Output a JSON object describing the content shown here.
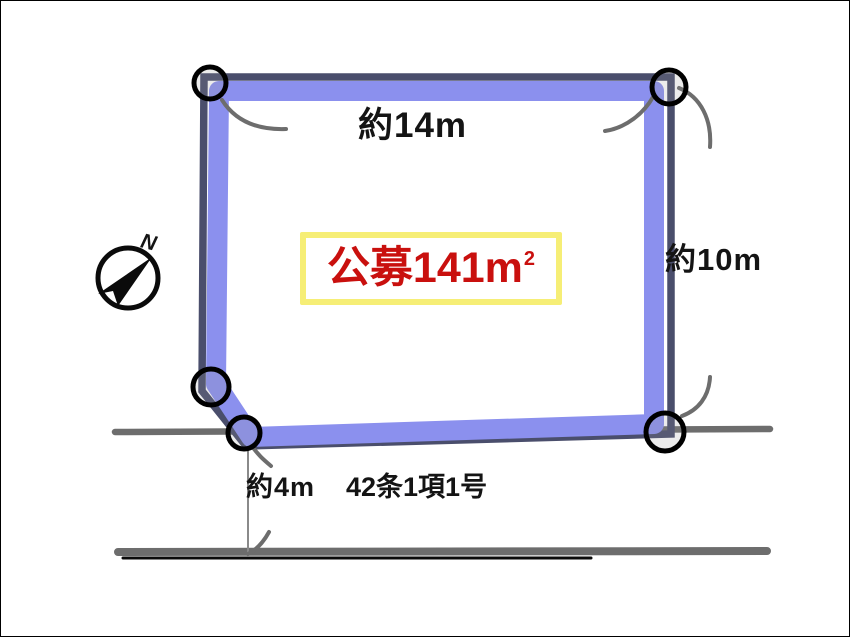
{
  "page": {
    "background": "#ffffff",
    "frame_color": "#000000"
  },
  "compass": {
    "north_label": "N",
    "direction": "northeast",
    "color": "#0b0b0b"
  },
  "plot": {
    "area_label": {
      "value": "公募141m",
      "sup": "2"
    },
    "area_text_color": "#c9100e",
    "area_box_border_color": "#f6ee76",
    "border_band_color": "#8b90ee",
    "outline_color": "#4a4e6c",
    "corner_marker_color": "#000000",
    "corner_marker_count": 5
  },
  "dimensions": {
    "top_edge": "約14m",
    "right_edge": "約10m",
    "road_width": "約4m"
  },
  "road": {
    "classification": "42条1項1号",
    "edge_color": "#6d6d6d"
  }
}
